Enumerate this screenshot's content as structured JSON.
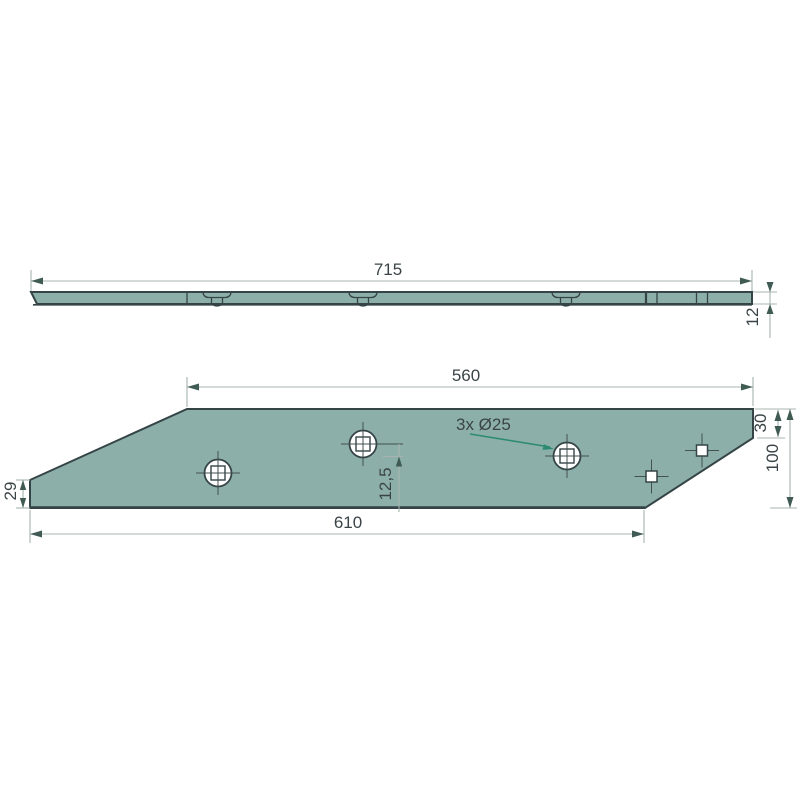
{
  "colors": {
    "plate": "#8DAFAA",
    "outline": "#354446",
    "dimline": "#A7B4B0",
    "arrow": "#3F5B54",
    "text": "#3A4447",
    "cross": "#43514F",
    "leader": "#2E8B73",
    "holefill": "#FFFFFF"
  },
  "views": {
    "side_view": {
      "dims": {
        "length": "715",
        "thickness": "12"
      }
    },
    "front_view": {
      "dims": {
        "top_width": "560",
        "corner_height": "30",
        "height": "100",
        "left_edge_height": "29",
        "bottom_width": "610",
        "hole_offset": "12,5"
      },
      "hole_note": "3x Ø25"
    }
  }
}
